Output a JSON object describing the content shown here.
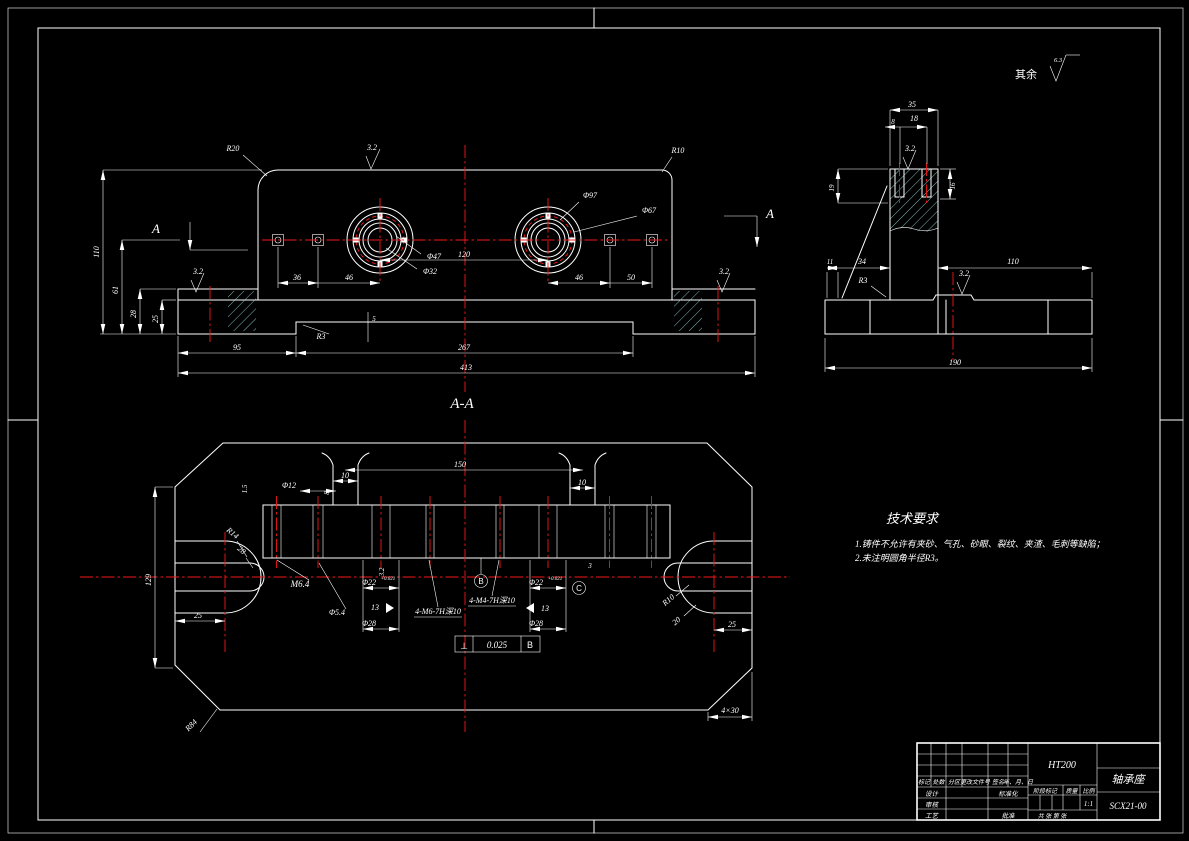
{
  "colors": {
    "background": "#000000",
    "line": "#ffffff",
    "centerline": "#f51818",
    "hatch": "#9fe6e6"
  },
  "annotations": {
    "surface_default_label": "其余",
    "surface_default_value": "6.3",
    "section_mark": "A",
    "section_title": "A-A"
  },
  "front": {
    "r20": "R20",
    "r10": "R10",
    "sf_top": "3.2",
    "sf_left": "3.2",
    "sf_right": "3.2",
    "d36": "36",
    "d46a": "46",
    "d46b": "46",
    "d50": "50",
    "d120": "120",
    "phi47": "Φ47",
    "phi32": "Φ32",
    "phi97": "Φ97",
    "phi67": "Φ67",
    "h110": "110",
    "h61": "61",
    "h28": "28",
    "h25": "25",
    "d95": "95",
    "d267": "267",
    "d413": "413",
    "r3": "R3",
    "d5": "5"
  },
  "side": {
    "d35": "35",
    "d8": "8",
    "d18": "18",
    "sf_top": "3.2",
    "d19": "19",
    "d16": "16",
    "d11": "11",
    "d34": "34",
    "r3": "R3",
    "d110": "110",
    "sf_base": "3.2",
    "d190": "190"
  },
  "section": {
    "d150": "150",
    "d10_left": "10",
    "d10_right": "10",
    "phi12": "Φ12",
    "d1_5": "1.5",
    "d8": "8",
    "m6": "M6.4",
    "phi5_4": "Φ5.4",
    "phi22_left": "Φ22",
    "phi22_right": "Φ22",
    "tol": "+0.021",
    "d13_left": "13",
    "d13_right": "13",
    "phi28_left": "Φ28",
    "phi28_right": "Φ28",
    "thread_left": "4-M6-7H深10",
    "thread_center": "4-M4-7H深10",
    "datum_b": "B",
    "datum_c": "C",
    "d3": "3",
    "gdt_symbol": "⊥",
    "gdt_value": "0.025",
    "gdt_datum": "B",
    "d129": "129",
    "d25_left": "25",
    "d25_right": "25",
    "r14": "R14",
    "d28_slot": "28",
    "r10": "R10",
    "d20": "20",
    "r84": "R84",
    "chamfer": "4×30"
  },
  "tech": {
    "title": "技术要求",
    "line1": "1.铸件不允许有夹砂、气孔、砂眼、裂纹、夹渣、毛刺等缺陷；",
    "line2": "2.未注明圆角半径R3。"
  },
  "title_block": {
    "material": "HT200",
    "part_name": "轴承座",
    "drawing_no": "SCX21-00",
    "scale_value": "1:1",
    "stage_label": "阶段标记",
    "weight_label": "质量",
    "scale_label": "比例",
    "sheet_label": "共 张 第 张",
    "headers": {
      "mark": "标记",
      "count": "处数",
      "zone": "分区",
      "doc": "更改文件号",
      "sign": "签名",
      "date": "年、月、日"
    },
    "roles": {
      "design": "设计",
      "check": "审核",
      "process": "工艺",
      "standard": "标准化",
      "approve": "批准"
    }
  }
}
